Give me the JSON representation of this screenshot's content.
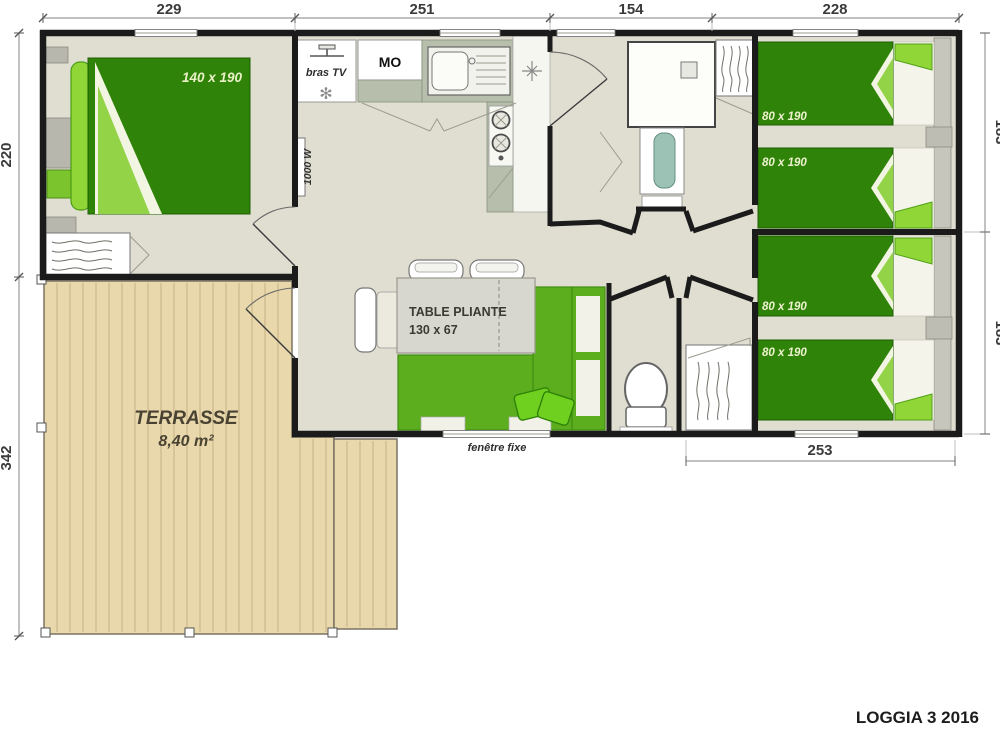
{
  "title": "LOGGIA 3 2016",
  "dims": {
    "top": [
      "229",
      "251",
      "154",
      "228"
    ],
    "left_upper": "220",
    "left_lower": "342",
    "right_upper": "183",
    "right_lower": "183",
    "bottom_right": "253"
  },
  "master": {
    "bed_size": "140 x 190"
  },
  "rooms": {
    "single_bed_sizes": [
      "80 x 190",
      "80 x 190",
      "80 x 190",
      "80 x 190"
    ]
  },
  "kitchen": {
    "tv_label": "bras TV",
    "microwave_label": "MO",
    "heater_label": "1000 W",
    "fan_icon_glyph": "✻"
  },
  "living": {
    "table_line1": "TABLE PLIANTE",
    "table_line2": "130 x 67"
  },
  "terrace": {
    "name": "TERRASSE",
    "area": "8,40 m²"
  },
  "bottom": {
    "window_label": "fenêtre fixe"
  },
  "colors": {
    "wall": "#1b1b1b",
    "floor": "#e0ded1",
    "terrace_deck": "#e8d8ab",
    "terrace_plank_line": "#c6b286",
    "bed_dark_green": "#2f8308",
    "bed_light_green": "#8fd636",
    "sofa_green": "#5cae1e",
    "counter_gray_green": "#b7bfac",
    "furniture_gray": "#b7b7ae",
    "table_gray": "#d7d7cf",
    "basin_teal": "#9cc2b6",
    "dimension_text": "#3b3b3b",
    "bed_label_text": "#eef3cf"
  }
}
